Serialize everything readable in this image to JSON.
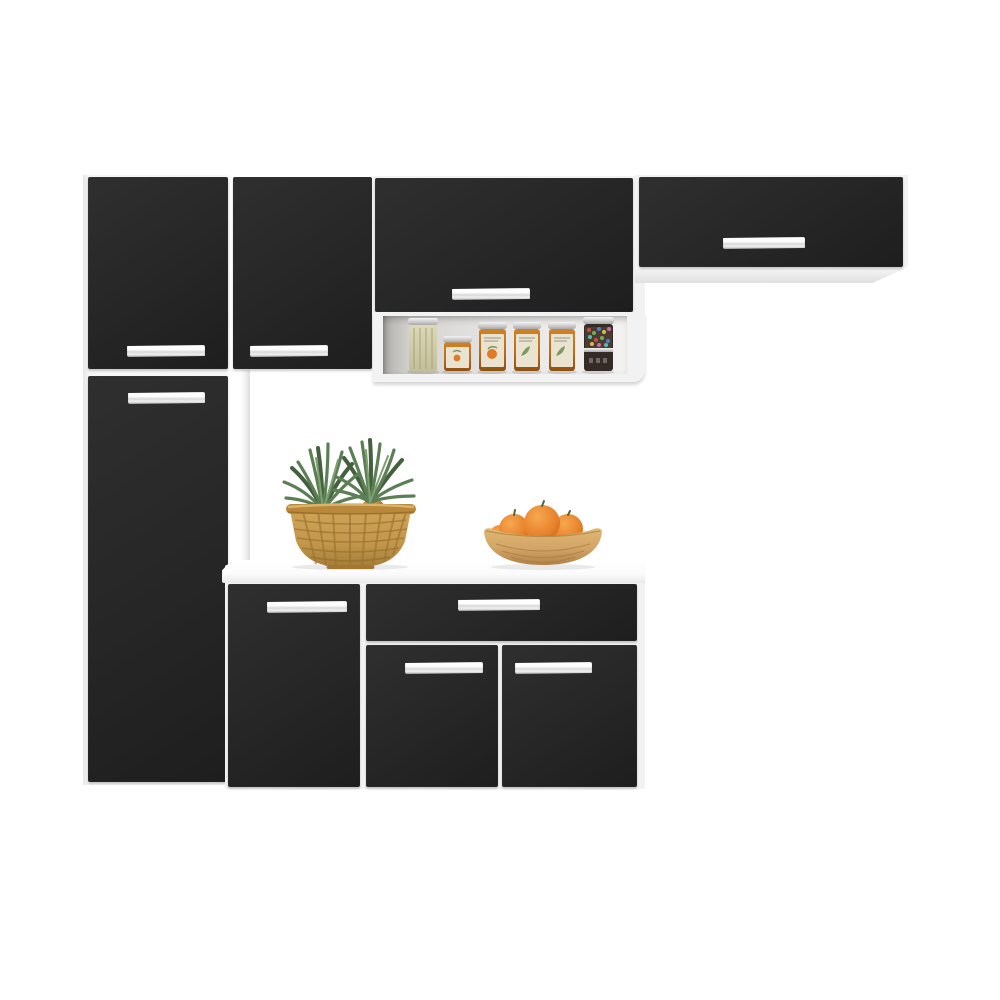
{
  "scene": {
    "description": "Product photo of a compact modular kitchen cabinet set with black doors, white frame and chrome bar handles, on a plain white background. Decor: two pineapples in a wicker basket and a wooden bowl of oranges on the white countertop, six pantry jars on an open shelf niche.",
    "background_color": "#ffffff"
  },
  "colors": {
    "bg": "#ffffff",
    "door": "#262626",
    "door-hi": "#2f2f2f",
    "door-lo": "#1e1e1e",
    "carcass": "#f2f2f2",
    "chrome": "#e8e8e8",
    "shelf-wall": "#d6d4d1",
    "basket": "#c2974c",
    "leaves": "#5d7f55",
    "leaves-dark": "#44613d",
    "pineapple": "#c9913f",
    "orange": "#e8832c",
    "bowl": "#d2a566",
    "amber": "#b96d1f",
    "jar-label": "#e9e3cf",
    "candy-jar": "#352b26"
  },
  "parts": {
    "tall_upper_door": "upper door of tall left cabinet",
    "tall_lower_door": "tall pantry door of left cabinet",
    "top_door_2": "second upper wall-cabinet door",
    "middle_door": "middle wall-cabinet flip-up door",
    "right_door": "right wall-cabinet flip-up door",
    "open_shelf": "open shelf niche with pantry jars",
    "support_post": "white vertical support post",
    "countertop": "white countertop",
    "base_left_door": "base cabinet left door",
    "drawer": "base cabinet drawer",
    "base_bottom_left_door": "base cabinet bottom left door",
    "base_bottom_right_door": "base cabinet bottom right door",
    "handle": "chrome bar handle"
  },
  "decor": {
    "basket_label": "wicker basket with two pineapples",
    "bowl_label": "wooden bowl with oranges",
    "jars": [
      "tall glass jar with dried herbs",
      "small amber preserve jar",
      "amber jar with fruit label",
      "amber jar with herb label",
      "amber jar with herb label",
      "dark jar with colorful candies"
    ]
  },
  "counts": {
    "doors": 8,
    "drawers": 1,
    "handles": 9,
    "jars_on_shelf": 6
  }
}
